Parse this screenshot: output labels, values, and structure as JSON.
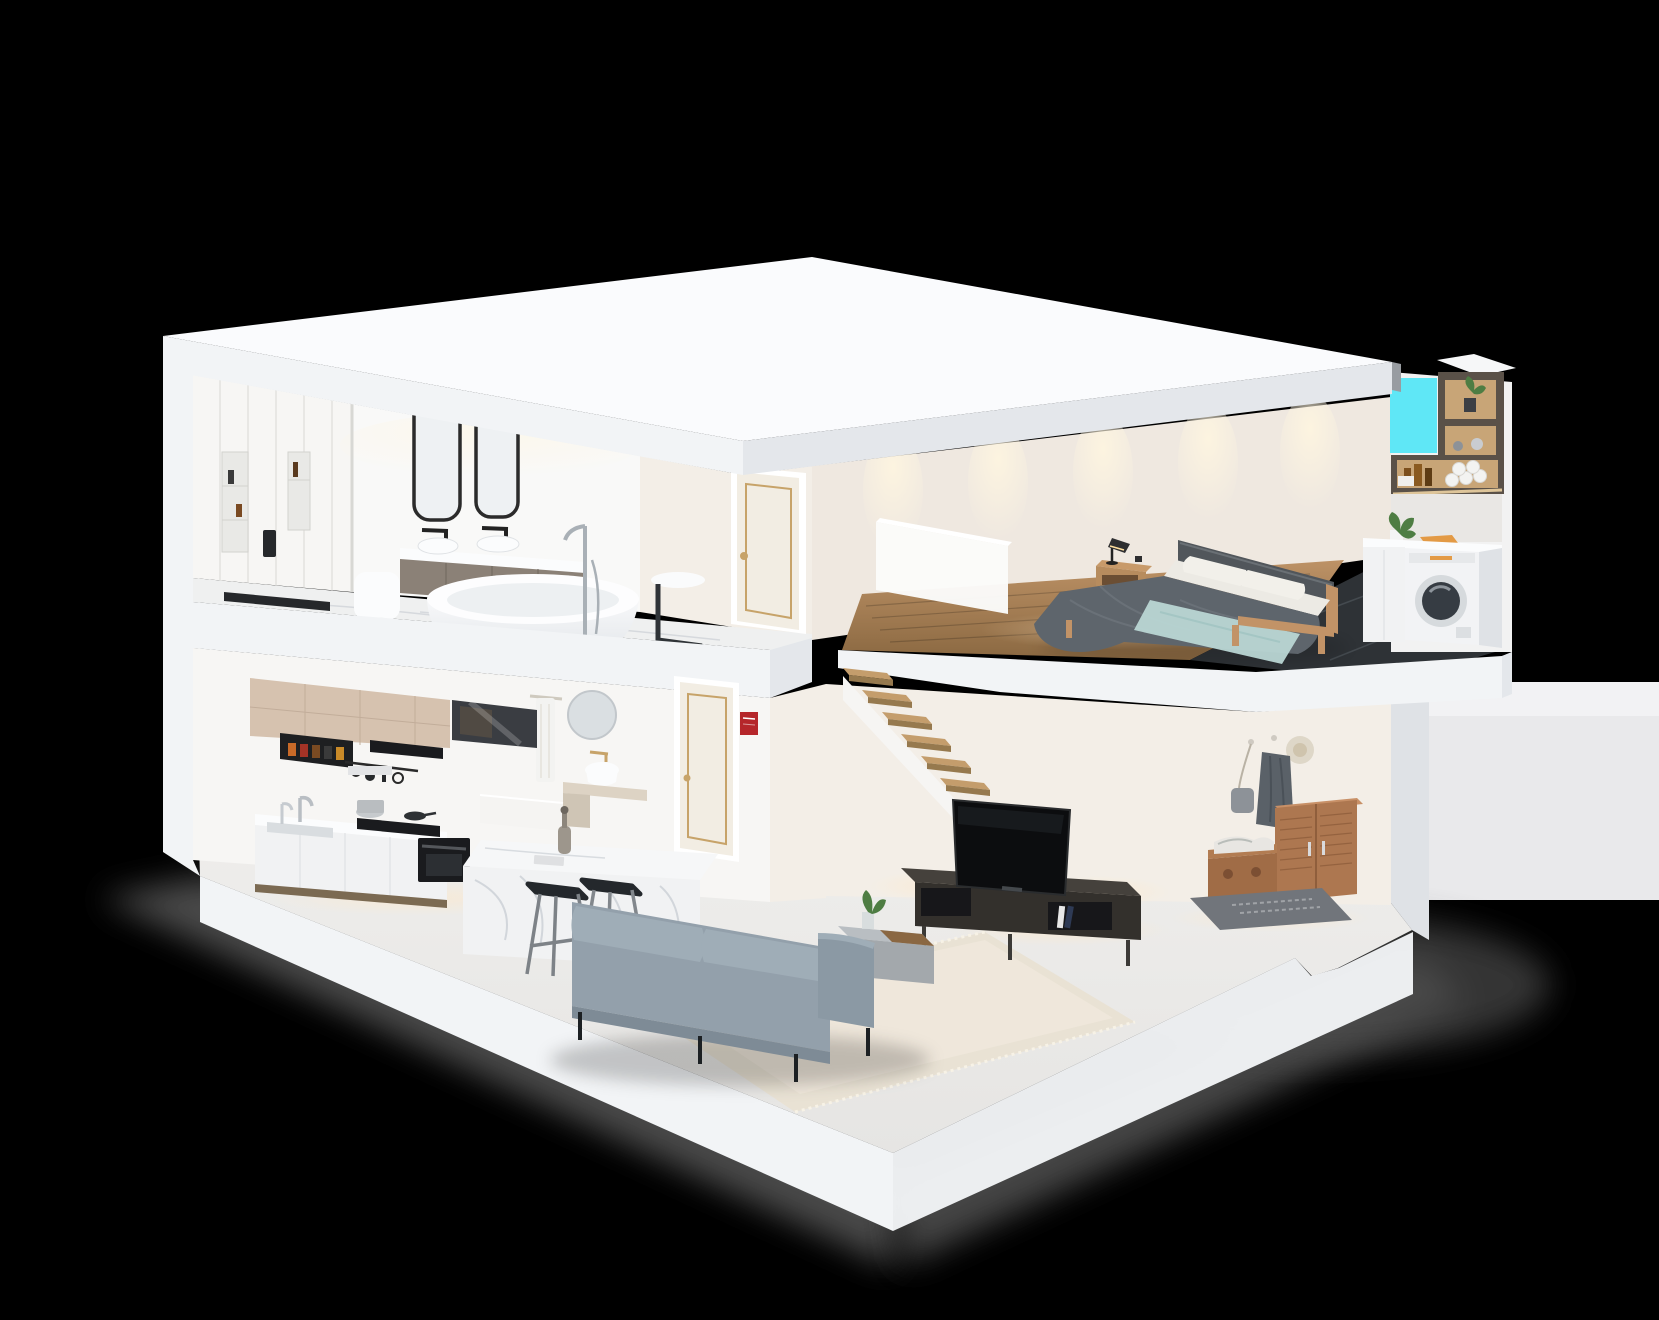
{
  "meta": {
    "description": "Isometric 3D cutaway dollhouse rendering of a two-storey loft apartment on a black background: upstairs bathroom with double vanity, freestanding tub and walk-in shower, hallway door, bedroom with double bed and laundry nook with washing machine; downstairs kitchen with marble island, small bathroom, wooden staircase, living room with grey sofa, TV bench and entryway wardrobe.",
    "render_type": "architectural-cutaway-3d-render",
    "visible_text": ""
  },
  "colors": {
    "bg": "#000000",
    "backdrop": "#e9e9eb",
    "backdrop_light": "#f2f2f4",
    "shadow": "#575757",
    "roof": "#fafbfd",
    "fascia": "#f2f4f6",
    "fascia_shade": "#e4e7eb",
    "wall": "#f7f6f4",
    "wall_warm": "#f3eee7",
    "wall_bedroom": "#efe8e0",
    "floor": "#edecea",
    "marble": "#eff0f0",
    "marble_vein": "#c4cad0",
    "wood_floor": "#b28a5c",
    "black_marble": "#2e3236",
    "window_cyan": "#5fe7f6",
    "door": "#f2ede3",
    "gold": "#c7a369",
    "black": "#26282b",
    "chrome": "#a9b0b6",
    "white_fixture": "#fbfcfd",
    "vanity_wood": "#8b8177",
    "cabinet_beige": "#d6c2af",
    "cabinet_white": "#f1f2f3",
    "appliance": "#1a1b1e",
    "stool": "#24282c",
    "sofa": "#93a0ab",
    "sofa_shade": "#7e8b96",
    "rug": "#e9e2d4",
    "tv": "#0c0d0f",
    "console": "#33302c",
    "coffee_table": "#a3a8ac",
    "wood_furniture": "#ad7750",
    "mat": "#71757b",
    "duvet": "#5e656c",
    "headboard": "#51565b",
    "throw": "#b9d6d4",
    "bed_wood": "#c29367",
    "pillow": "#f2f0ea",
    "shelf_dark": "#5a5148",
    "shelf_lit": "#c8a577",
    "towel": "#f3f3f1",
    "plant": "#4e7d43",
    "orange": "#e39a45",
    "sign_red": "#b5262a",
    "tread": "#c49d6c",
    "tread_shade": "#96794e"
  },
  "scene": {
    "floors": [
      {
        "id": "upper",
        "rooms": [
          {
            "id": "bathroom-upper",
            "items": [
              "walk-in-shower",
              "rain-shower-head",
              "wall-niches",
              "shower-bench",
              "black-shower-tray",
              "mirror-pair",
              "double-vanity",
              "vessel-sinks",
              "toilet",
              "freestanding-bathtub",
              "floor-tub-faucet",
              "side-table",
              "marble-floor"
            ]
          },
          {
            "id": "upper-hallway",
            "items": [
              "cream-door-gold-trim"
            ]
          },
          {
            "id": "bedroom",
            "items": [
              "double-bed",
              "grey-duvet",
              "white-pillows",
              "light-blue-throw",
              "dark-headboard",
              "wood-nightstand",
              "desk-lamp",
              "frosted-parapet",
              "wood-plank-floor",
              "wall-spotlights"
            ]
          },
          {
            "id": "laundry-nook",
            "items": [
              "washing-machine",
              "white-cabinet",
              "counter",
              "potted-plant",
              "orange-cloth",
              "dark-wood-shelving",
              "rolled-towels",
              "amber-bottles",
              "black-marble-floor",
              "window-cutout"
            ]
          }
        ]
      },
      {
        "id": "lower",
        "rooms": [
          {
            "id": "kitchen",
            "items": [
              "beige-upper-cabinets",
              "open-spice-shelf",
              "glass-cabinet",
              "range-hood",
              "utensil-rail",
              "sink",
              "tall-faucet",
              "gas-cooktop",
              "stock-pot",
              "built-in-oven",
              "white-base-cabinets",
              "marble-island",
              "decanter",
              "bar-stools"
            ]
          },
          {
            "id": "bathroom-lower",
            "items": [
              "round-mirror",
              "hanging-towel",
              "gold-faucet",
              "vessel-sink",
              "stone-vanity",
              "cream-door",
              "red-safety-sign",
              "half-wall"
            ]
          },
          {
            "id": "staircase",
            "items": [
              "wood-treads",
              "white-stringer"
            ]
          },
          {
            "id": "living-room",
            "items": [
              "grey-fabric-sofa",
              "cream-rug",
              "tv",
              "dark-tv-bench",
              "books",
              "coffee-table",
              "table-plant"
            ]
          },
          {
            "id": "entryway",
            "items": [
              "coat-hooks",
              "straw-hat",
              "grey-coat",
              "shoulder-bag",
              "wood-shoe-cabinet",
              "storage-bench",
              "doormat"
            ]
          }
        ]
      }
    ]
  }
}
